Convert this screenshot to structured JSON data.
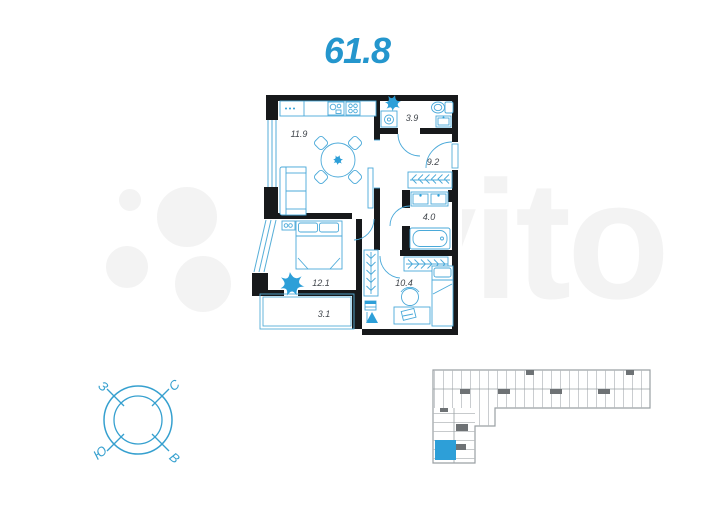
{
  "title": {
    "total_area": "61.8"
  },
  "watermark": {
    "brand": "Avito"
  },
  "floor_plan": {
    "rooms": [
      {
        "name": "kitchen-living-room",
        "area": "11.9"
      },
      {
        "name": "bathroom-wc",
        "area": "3.9"
      },
      {
        "name": "hallway",
        "area": "9.2"
      },
      {
        "name": "bathroom",
        "area": "4.0"
      },
      {
        "name": "bedroom",
        "area": "12.1"
      },
      {
        "name": "balcony",
        "area": "3.1"
      },
      {
        "name": "room",
        "area": "10.4"
      }
    ]
  },
  "compass": {
    "north": "С",
    "south": "Ю",
    "west": "З",
    "east": "В"
  },
  "colors": {
    "accent": "#2496cd",
    "plan_line": "#4aa9d9",
    "wall": "#17191b",
    "fixture_fill": "#2d9fd8",
    "building_line": "#a7abae",
    "highlight": "#2d9fd8",
    "watermark": "#f3f3f3"
  }
}
